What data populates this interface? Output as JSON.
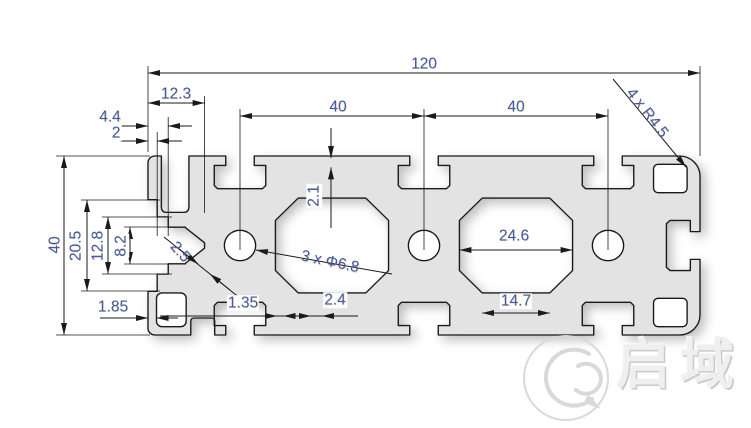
{
  "colors": {
    "dim_text": "#3f5ca6",
    "line_color": "#1a1a1a",
    "profile_fill": "#e3e3e3",
    "watermark_color": "#d9d9d9"
  },
  "dims": {
    "overall_width": "120",
    "left_offset": "12.3",
    "left_step_outer": "4.4",
    "left_step_inner": "2",
    "slot_pitch_left": "40",
    "slot_pitch_right": "40",
    "corner_radius": "4 x R4.5",
    "top_wall": "2.1",
    "holes": "3 x Φ6.8",
    "diagonal_wall": "2.5",
    "cavity_width": "24.6",
    "cavity_bottom_width": "14.7",
    "rib_wall": "1.35",
    "bottom_wall": "2.4",
    "left_wall": "1.85",
    "overall_height": "40",
    "left_slot_outer": "20.5",
    "left_slot_mid": "12.8",
    "left_slot_inner": "8.2"
  },
  "watermark": {
    "brand": "启域",
    "logo": "qiyu-q-logo"
  }
}
